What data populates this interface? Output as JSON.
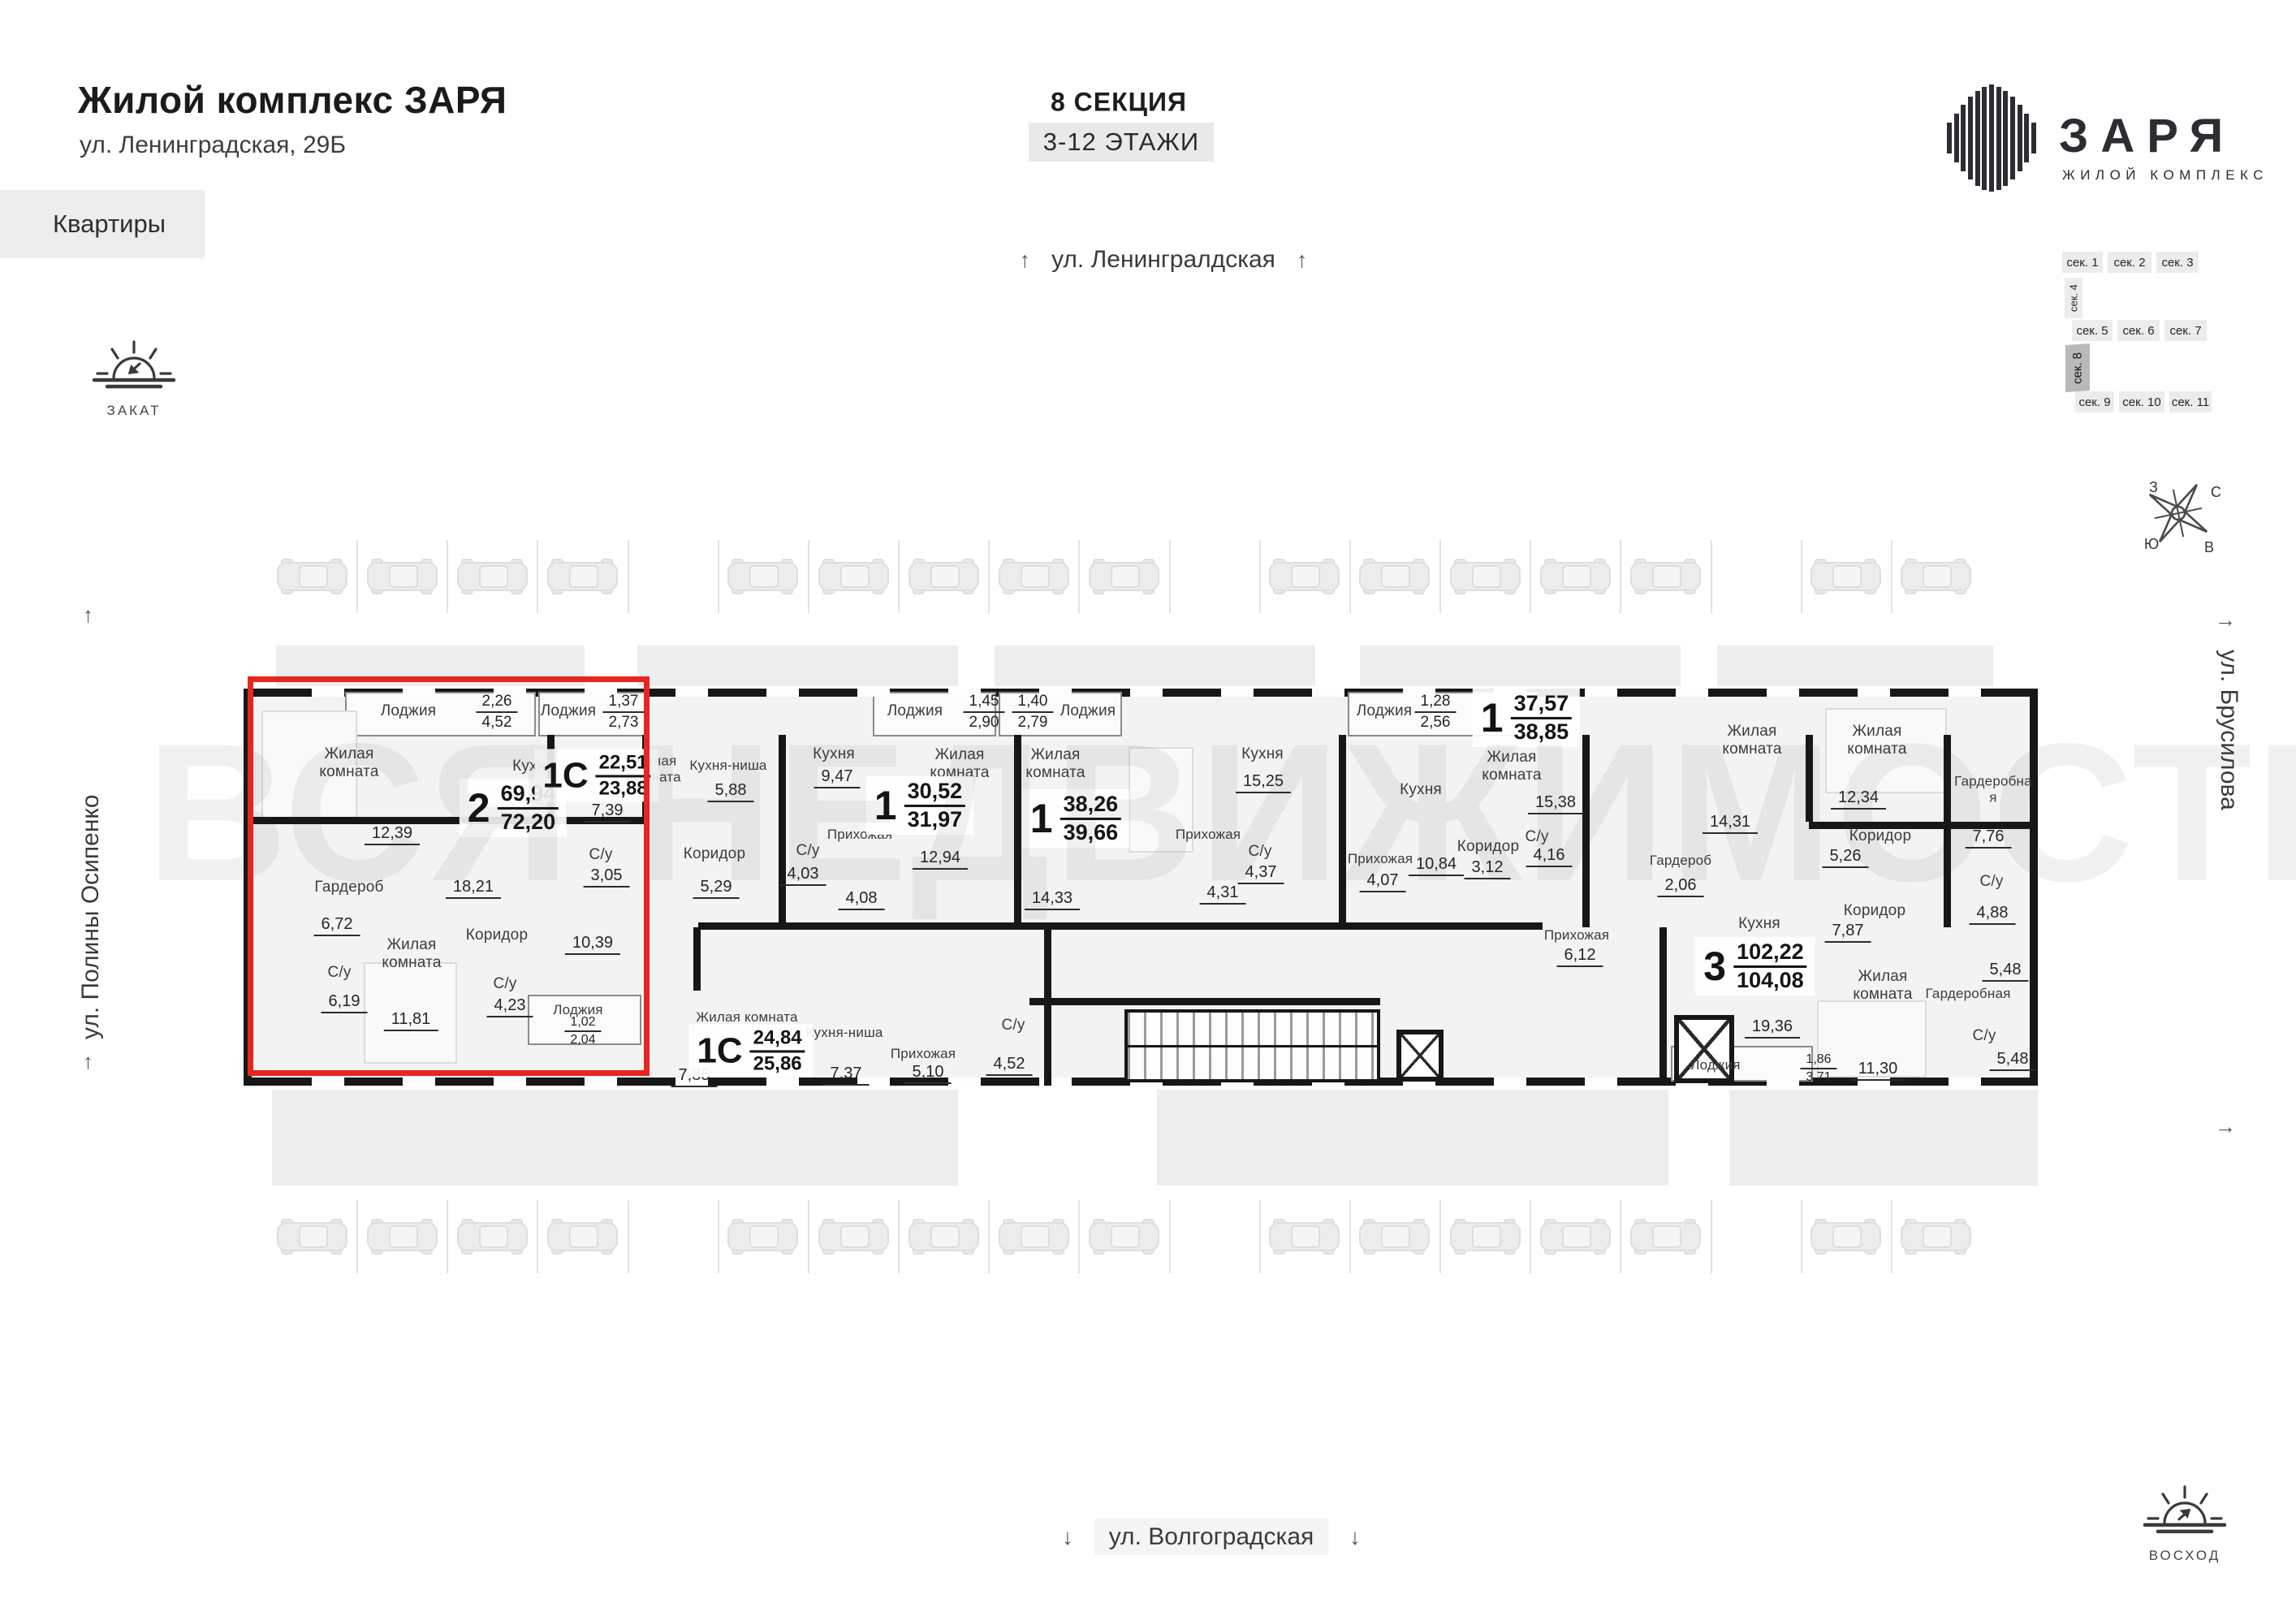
{
  "header": {
    "title": "Жилой комплекс ЗАРЯ",
    "address": "ул. Ленинградская, 29Б",
    "tab": "Квартиры"
  },
  "section": {
    "name": "8 СЕКЦИЯ",
    "floors": "3-12 ЭТАЖИ"
  },
  "streets": {
    "top": "ул. Ленингралдская",
    "bottom": "ул. Волгоградская",
    "left": "ул. Полины Осипенко",
    "right": "ул. Брусилова"
  },
  "sun": {
    "sunset": "ЗАКАТ",
    "sunrise": "ВОСХОД"
  },
  "logo": {
    "name": "ЗАРЯ",
    "subtitle": "ЖИЛОЙ КОМПЛЕКС"
  },
  "watermark": "ВСЯ НЕДВИЖИМОСТЬ",
  "compass": {
    "n": "С",
    "e": "В",
    "s": "Ю",
    "w": "З"
  },
  "section_map": {
    "row1": [
      "сек. 1",
      "сек. 2",
      "сек. 3"
    ],
    "v1": "сек. 4",
    "row2": [
      "сек. 5",
      "сек. 6",
      "сек. 7"
    ],
    "v2": "сек. 8",
    "row3": [
      "сек. 9",
      "сек. 10",
      "сек. 11"
    ]
  },
  "parking": {
    "rows": 2,
    "stalls_per_row": 19
  },
  "colors": {
    "accent_red": "#e8261f",
    "wall": "#171717",
    "plan_fill": "#f3f3f3"
  },
  "apartments": {
    "a2": {
      "type": "2",
      "area": "69,94",
      "total": "72,20",
      "living1": {
        "n": "Жилая комната",
        "v": "12,39"
      },
      "loggia": {
        "n": "Лоджия",
        "a": "2,26",
        "b": "4,52"
      },
      "kitchen": {
        "n": "Кухня",
        "v": "18,21"
      },
      "wardrobe": {
        "n": "Гардероб",
        "v": "6,72"
      },
      "bath1": {
        "n": "С/у",
        "v": "6,19"
      },
      "living2": {
        "n": "Жилая комната",
        "v": "11,81"
      },
      "bath2": {
        "n": "С/у",
        "v": "4,23"
      },
      "corridor": {
        "n": "Коридор",
        "v": "10,39"
      }
    },
    "s1": {
      "type": "1С",
      "area": "22,51",
      "total": "23,88",
      "loggia": {
        "n": "Лоджия",
        "a": "1,37",
        "b": "2,73"
      },
      "living": {
        "n": "Жилая комната",
        "v": "7,39"
      },
      "bath": {
        "n": "С/у",
        "v": "3,05"
      },
      "kitchen": {
        "n": "Кухня-ниша",
        "v": "5,88"
      },
      "corridor": {
        "n": "Коридор",
        "v": "5,29"
      }
    },
    "b1": {
      "type": "1",
      "area": "30,52",
      "total": "31,97",
      "kitchen": {
        "n": "Кухня",
        "v": "9,47"
      },
      "bath": {
        "n": "С/у",
        "v": "4,03"
      },
      "hall": {
        "n": "Прихожая",
        "v": "4,08"
      },
      "living": {
        "n": "Жилая комната",
        "v": "12,94"
      },
      "loggia": {
        "n": "Лоджия",
        "a": "1,45",
        "b": "2,90"
      }
    },
    "b2": {
      "type": "1",
      "area": "38,26",
      "total": "39,66",
      "loggia": {
        "n": "Лоджия",
        "a": "1,40",
        "b": "2,79"
      },
      "living": {
        "n": "Жилая комната",
        "v": "14,33"
      },
      "kitchen": {
        "n": "Кухня",
        "v": "15,25"
      },
      "hall": {
        "n": "Прихожая",
        "v": "4,31"
      },
      "bath": {
        "n": "С/у",
        "v": "4,37"
      }
    },
    "b3": {
      "type": "1",
      "area": "37,57",
      "total": "38,85",
      "loggia": {
        "n": "Лоджия",
        "a": "1,28",
        "b": "2,56"
      },
      "kitchen": {
        "n": "Кухня",
        "v": "10,84"
      },
      "hall": {
        "n": "Прихожая",
        "v": "4,07"
      },
      "corridor": {
        "n": "Коридор",
        "v": "3,12"
      },
      "bath": {
        "n": "С/у",
        "v": "4,16"
      },
      "living": {
        "n": "Жилая комната",
        "v": "15,38"
      }
    },
    "s2": {
      "type": "1С",
      "area": "24,84",
      "total": "25,86",
      "living": {
        "n": "Жилая комната",
        "v": "7,85"
      },
      "kitchen": {
        "n": "Кухня-ниша",
        "v": "7,37"
      },
      "hall": {
        "n": "Прихожая",
        "v": "5,10"
      },
      "bath": {
        "n": "С/у",
        "v": "4,52"
      },
      "loggia": {
        "n": "Лоджия",
        "a": "1,02",
        "b": "2,04"
      }
    },
    "a3": {
      "type": "3",
      "area": "102,22",
      "total": "104,08",
      "hall": {
        "n": "Прихожая",
        "v": "6,12"
      },
      "wardrobe1": {
        "n": "Гардероб",
        "v": "2,06"
      },
      "kitchen": {
        "n": "Кухня",
        "v": "19,36"
      },
      "living1": {
        "n": "Жилая комната",
        "v": "14,31"
      },
      "living2": {
        "n": "Жилая комната",
        "v": "12,34"
      },
      "corridor1": {
        "n": "Коридор",
        "v": "5,26"
      },
      "wardrobe2": {
        "n": "Гардеробная",
        "v": "7,76"
      },
      "corridor2": {
        "n": "Коридор",
        "v": "7,87"
      },
      "bath1": {
        "n": "С/у",
        "v": "4,88"
      },
      "living3": {
        "n": "Жилая комната",
        "v": "11,30"
      },
      "wardrobe3": {
        "n": "Гардеробная",
        "v": "5,48"
      },
      "bath2": {
        "n": "С/у",
        "v": "5,48"
      },
      "loggia": {
        "n": "Лоджия",
        "a": "1,86",
        "b": "3,71"
      }
    }
  }
}
